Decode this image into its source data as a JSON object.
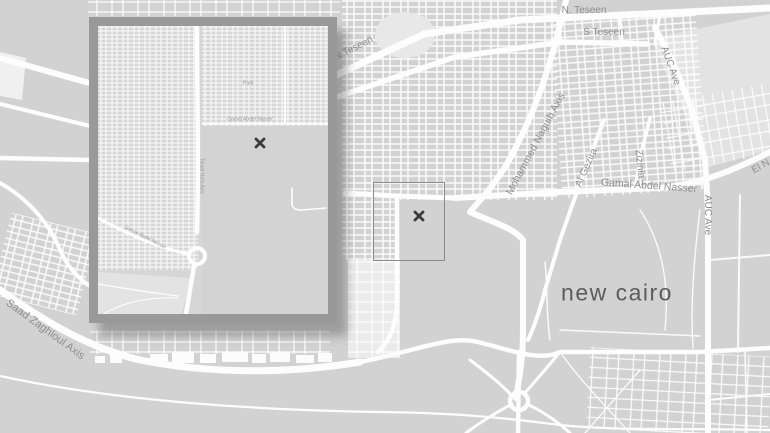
{
  "map": {
    "colors": {
      "background": "#d2d2d2",
      "road": "#ffffff",
      "street_label": "#8f8f8f",
      "city_label": "#5c5c5c",
      "light_area": "#e4e4e4",
      "pond": "#e8e8e8",
      "marker": "#3c3c3c",
      "viewport_border": "#8a8a8a",
      "inset_frame": "rgba(98,98,98,0.52)"
    },
    "labels": {
      "n_teseen": "N. Teseen",
      "s_teseen": "S Teseen",
      "n_teseen_diag": "N Teseen",
      "auc_ave_upper": "AUC Ave",
      "auc_ave_lower": "AUC Ave",
      "el_n": "El N",
      "mohammed_naguib_axis": "Mohammed Naguib Axis",
      "al_gezira": "Al Gezira",
      "zizinia": "Zizinia",
      "gamal_abdel_nasser": "Gamal Abdel Nasser",
      "saad_zaghloul_axis": "Saad Zaghloul Axis",
      "city": "new cairo"
    },
    "markers": {
      "main_x": "x-location-marker",
      "inset_x": "x-location-marker"
    }
  },
  "inset": {
    "labels": {
      "talaat_harb_axis": "Talaat Harb Axis",
      "gamal_abdel_nasser_h": "Gamal Abdel Nasser",
      "gamal_abdel_nasser_d": "Gamal Abdel Nasser",
      "park": "Park"
    }
  }
}
